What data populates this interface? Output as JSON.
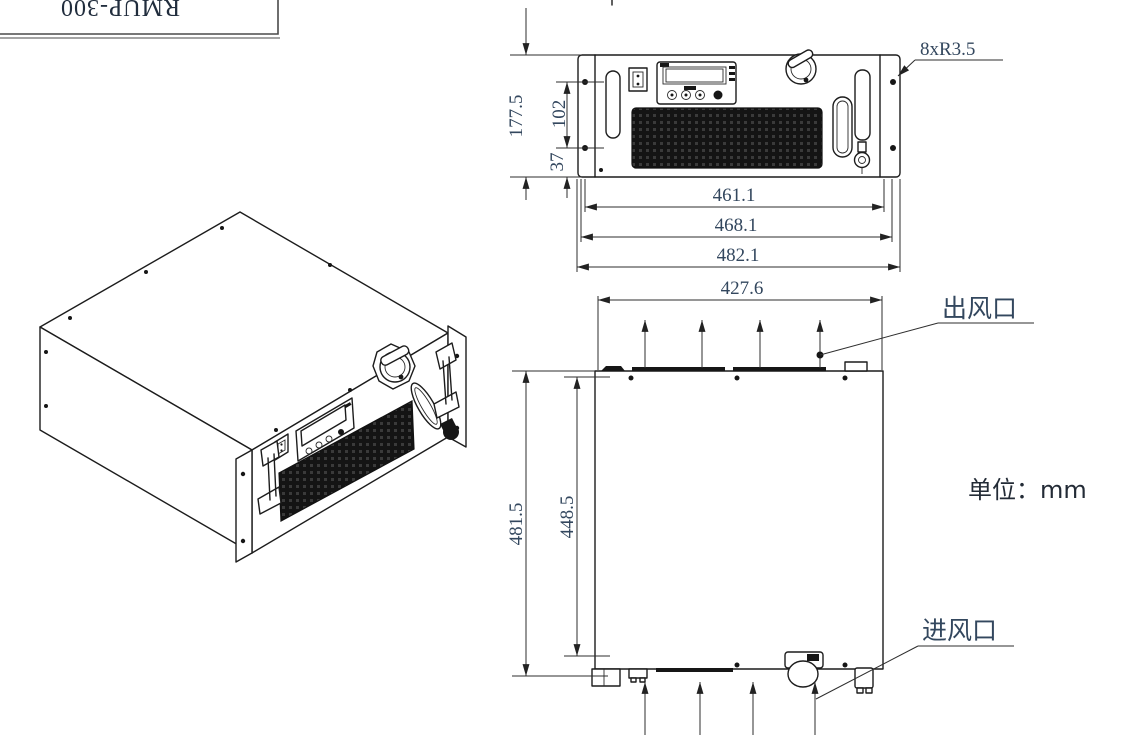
{
  "drawing": {
    "title_block": {
      "model": "RMUP-300"
    },
    "units_note": "单位：mm",
    "front_view": {
      "hole_note": "8xR3.5",
      "dim_height": "177.5",
      "dim_panel": "102",
      "dim_bottom": "37",
      "dim_width_inner": "461.1",
      "dim_width_mid": "468.1",
      "dim_width_outer": "482.1"
    },
    "top_view": {
      "dim_width": "427.6",
      "dim_depth_outer": "481.5",
      "dim_depth_inner": "448.5",
      "air_outlet_label": "出风口",
      "air_inlet_label": "进风口"
    },
    "colors": {
      "line": "#1c1c1c",
      "dim_text": "#33475e",
      "grille_fill": "#161616"
    }
  }
}
